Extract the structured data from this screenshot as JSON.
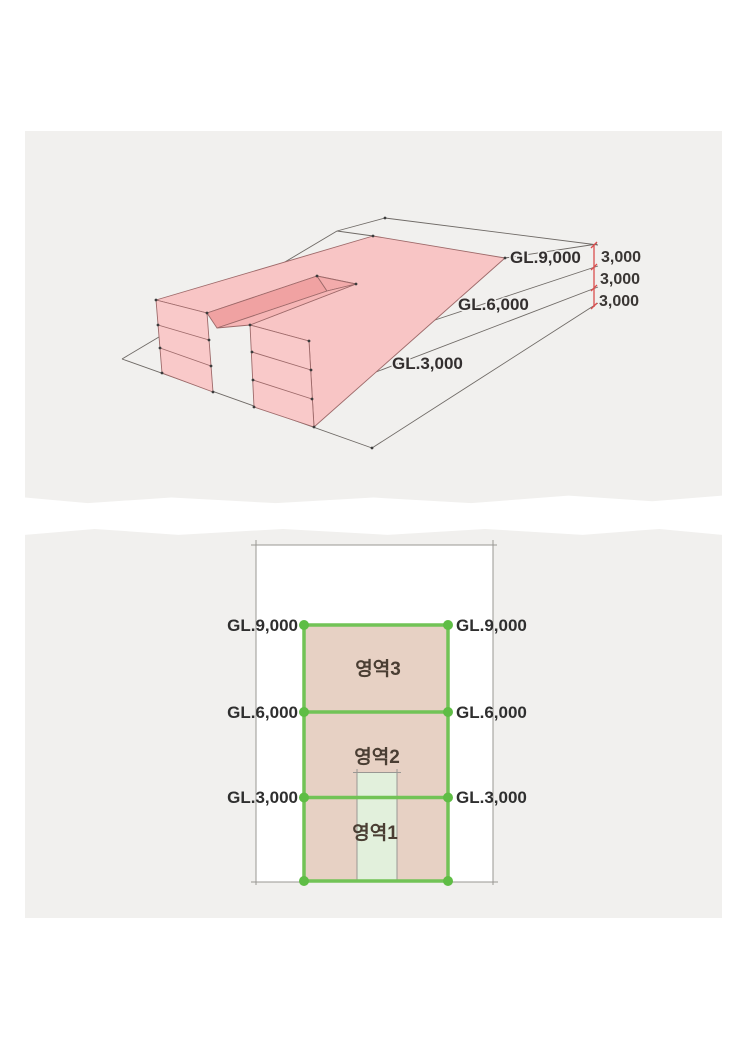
{
  "upper_diagram": {
    "gl_labels": {
      "gl_9000": "GL.9,000",
      "gl_6000": "GL.6,000",
      "gl_3000": "GL.3,000"
    },
    "dimensions": [
      "3,000",
      "3,000",
      "3,000"
    ],
    "colors": {
      "mass_pink": "#f8c5c5",
      "mass_end_face": "#f9c9c9",
      "notch_wall_dark": "#f0a2a2",
      "notch_floor": "#f6b6b6",
      "dimension_red": "#d94f4f"
    }
  },
  "lower_diagram": {
    "gl_labels_left": [
      "GL.9,000",
      "GL.6,000",
      "GL.3,000"
    ],
    "gl_labels_right": [
      "GL.9,000",
      "GL.6,000",
      "GL.3,000"
    ],
    "area_labels": [
      "영역3",
      "영역2",
      "영역1"
    ],
    "colors": {
      "site_tan": "#e7d1c4",
      "strip_green": "#e2f0dc",
      "boundary_green": "#72c356",
      "node_green": "#5fbd45"
    }
  }
}
